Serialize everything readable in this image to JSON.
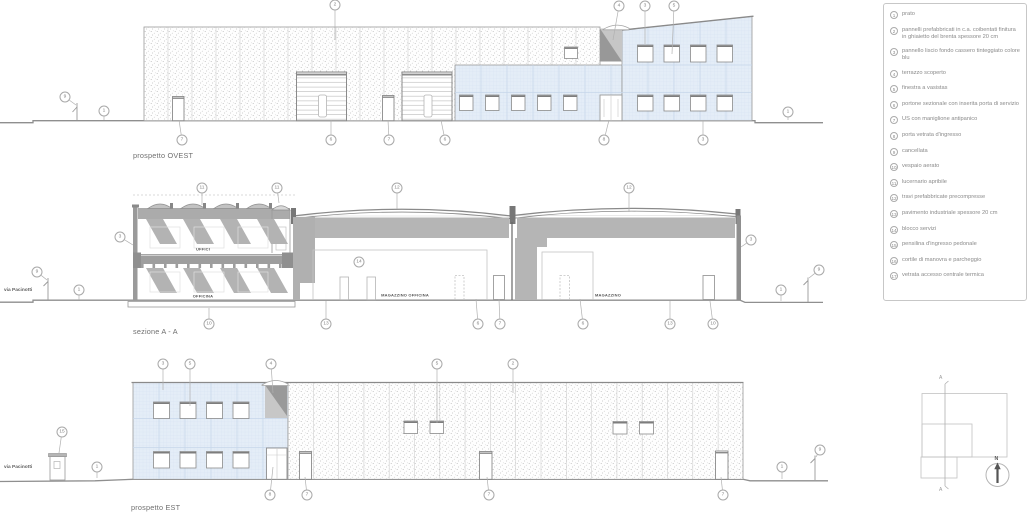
{
  "colors": {
    "panel_blue": "#e4edf7",
    "grid_blue": "#d2e0ef",
    "mid_gray": "#b5b5b5",
    "dark_gray": "#8f8f8f",
    "line_gray": "#9a9a9a",
    "text_gray": "#8a8a8a"
  },
  "drawings": {
    "ovest": {
      "title": "prospetto OVEST",
      "callouts": [
        {
          "n": "9",
          "x": 65,
          "y": 97,
          "lx": 76,
          "ly": 105
        },
        {
          "n": "1",
          "x": 104,
          "y": 111,
          "lx": 104,
          "ly": 120
        },
        {
          "n": "2",
          "x": 335,
          "y": 5,
          "lx": 335,
          "ly": 40
        },
        {
          "n": "7",
          "x": 182,
          "y": 140,
          "lx": 179,
          "ly": 120
        },
        {
          "n": "6",
          "x": 331,
          "y": 140,
          "lx": 331,
          "ly": 120
        },
        {
          "n": "7",
          "x": 389,
          "y": 140,
          "lx": 388,
          "ly": 120
        },
        {
          "n": "6",
          "x": 445,
          "y": 140,
          "lx": 441,
          "ly": 120
        },
        {
          "n": "4",
          "x": 619,
          "y": 6,
          "lx": 613,
          "ly": 40
        },
        {
          "n": "3",
          "x": 645,
          "y": 6,
          "lx": 645,
          "ly": 44
        },
        {
          "n": "5",
          "x": 674,
          "y": 6,
          "lx": 672,
          "ly": 54
        },
        {
          "n": "8",
          "x": 604,
          "y": 140,
          "lx": 609,
          "ly": 120
        },
        {
          "n": "3",
          "x": 703,
          "y": 140,
          "lx": 703,
          "ly": 120
        },
        {
          "n": "1",
          "x": 788,
          "y": 112,
          "lx": 788,
          "ly": 120
        }
      ]
    },
    "sezione": {
      "title": "sezione A - A",
      "street": "via Pacinotti",
      "rooms": [
        {
          "label": "UFFICI",
          "x": 203,
          "y": 249
        },
        {
          "label": "OFFICINA",
          "x": 203,
          "y": 296
        },
        {
          "label": "MAGAZZINO OFFICINA",
          "x": 405,
          "y": 295
        },
        {
          "label": "MAGAZZINO",
          "x": 608,
          "y": 295
        }
      ],
      "callouts": [
        {
          "n": "9",
          "x": 37,
          "y": 272,
          "lx": 47,
          "ly": 280
        },
        {
          "n": "1",
          "x": 79,
          "y": 290,
          "lx": 79,
          "ly": 300
        },
        {
          "n": "3",
          "x": 120,
          "y": 237,
          "lx": 133,
          "ly": 245
        },
        {
          "n": "11",
          "x": 202,
          "y": 188,
          "lx": 202,
          "ly": 205
        },
        {
          "n": "11",
          "x": 277,
          "y": 188,
          "lx": 279,
          "ly": 203
        },
        {
          "n": "12",
          "x": 397,
          "y": 188,
          "lx": 397,
          "ly": 209
        },
        {
          "n": "12",
          "x": 629,
          "y": 188,
          "lx": 629,
          "ly": 212
        },
        {
          "n": "14",
          "x": 359,
          "y": 262
        },
        {
          "n": "3",
          "x": 751,
          "y": 240,
          "lx": 741,
          "ly": 247
        },
        {
          "n": "9",
          "x": 819,
          "y": 270,
          "lx": 809,
          "ly": 278
        },
        {
          "n": "1",
          "x": 781,
          "y": 290,
          "lx": 781,
          "ly": 301
        },
        {
          "n": "10",
          "x": 209,
          "y": 324,
          "lx": 209,
          "ly": 308
        },
        {
          "n": "13",
          "x": 326,
          "y": 324,
          "lx": 326,
          "ly": 301
        },
        {
          "n": "6",
          "x": 478,
          "y": 324,
          "lx": 476,
          "ly": 299
        },
        {
          "n": "7",
          "x": 500,
          "y": 324,
          "lx": 499,
          "ly": 299
        },
        {
          "n": "6",
          "x": 583,
          "y": 324,
          "lx": 580,
          "ly": 299
        },
        {
          "n": "13",
          "x": 670,
          "y": 324,
          "lx": 670,
          "ly": 301
        },
        {
          "n": "10",
          "x": 713,
          "y": 324,
          "lx": 710,
          "ly": 301
        }
      ]
    },
    "est": {
      "title": "prospetto EST",
      "street": "via Pacinotti",
      "callouts": [
        {
          "n": "15",
          "x": 62,
          "y": 432,
          "lx": 59,
          "ly": 453
        },
        {
          "n": "1",
          "x": 97,
          "y": 467,
          "lx": 97,
          "ly": 478
        },
        {
          "n": "3",
          "x": 163,
          "y": 364,
          "lx": 163,
          "ly": 390
        },
        {
          "n": "5",
          "x": 190,
          "y": 364,
          "lx": 190,
          "ly": 406
        },
        {
          "n": "4",
          "x": 271,
          "y": 364,
          "lx": 273,
          "ly": 393
        },
        {
          "n": "5",
          "x": 437,
          "y": 364,
          "lx": 437,
          "ly": 423
        },
        {
          "n": "2",
          "x": 513,
          "y": 364,
          "lx": 513,
          "ly": 393
        },
        {
          "n": "8",
          "x": 270,
          "y": 495,
          "lx": 273,
          "ly": 467
        },
        {
          "n": "7",
          "x": 307,
          "y": 495,
          "lx": 305,
          "ly": 477
        },
        {
          "n": "7",
          "x": 489,
          "y": 495,
          "lx": 487,
          "ly": 477
        },
        {
          "n": "7",
          "x": 723,
          "y": 495,
          "lx": 721,
          "ly": 477
        },
        {
          "n": "1",
          "x": 782,
          "y": 467,
          "lx": 782,
          "ly": 479
        },
        {
          "n": "9",
          "x": 820,
          "y": 450,
          "lx": 816,
          "ly": 457
        }
      ]
    }
  },
  "legend": {
    "items": [
      {
        "n": "1",
        "text": "prato"
      },
      {
        "n": "2",
        "text": "pannelli prefabbricati in c.a. coibentati finitura in ghiaietto del brenta spessore 20 cm"
      },
      {
        "n": "3",
        "text": "pannello liscio fondo cassero tinteggiato colore blu"
      },
      {
        "n": "4",
        "text": "terrazzo scoperto"
      },
      {
        "n": "5",
        "text": "finestra a vasistas"
      },
      {
        "n": "6",
        "text": "portone sezionale con inserita porta di servizio"
      },
      {
        "n": "7",
        "text": "US con maniglione antipanico"
      },
      {
        "n": "8",
        "text": "porta vetrata d'ingresso"
      },
      {
        "n": "9",
        "text": "cancellata"
      },
      {
        "n": "10",
        "text": "vespaio aerato"
      },
      {
        "n": "11",
        "text": "lucernario apribile"
      },
      {
        "n": "12",
        "text": "travi prefabbricate precompresse"
      },
      {
        "n": "13",
        "text": "pavimento industriale spessore 20 cm"
      },
      {
        "n": "14",
        "text": "blocco servizi"
      },
      {
        "n": "15",
        "text": "pensilina d'ingresso pedonale"
      },
      {
        "n": "16",
        "text": "cortile di manovra e parcheggio"
      },
      {
        "n": "17",
        "text": "vetrata accesso centrale termica"
      }
    ]
  },
  "key_plan": {
    "section_letter": "A",
    "north": "N"
  }
}
